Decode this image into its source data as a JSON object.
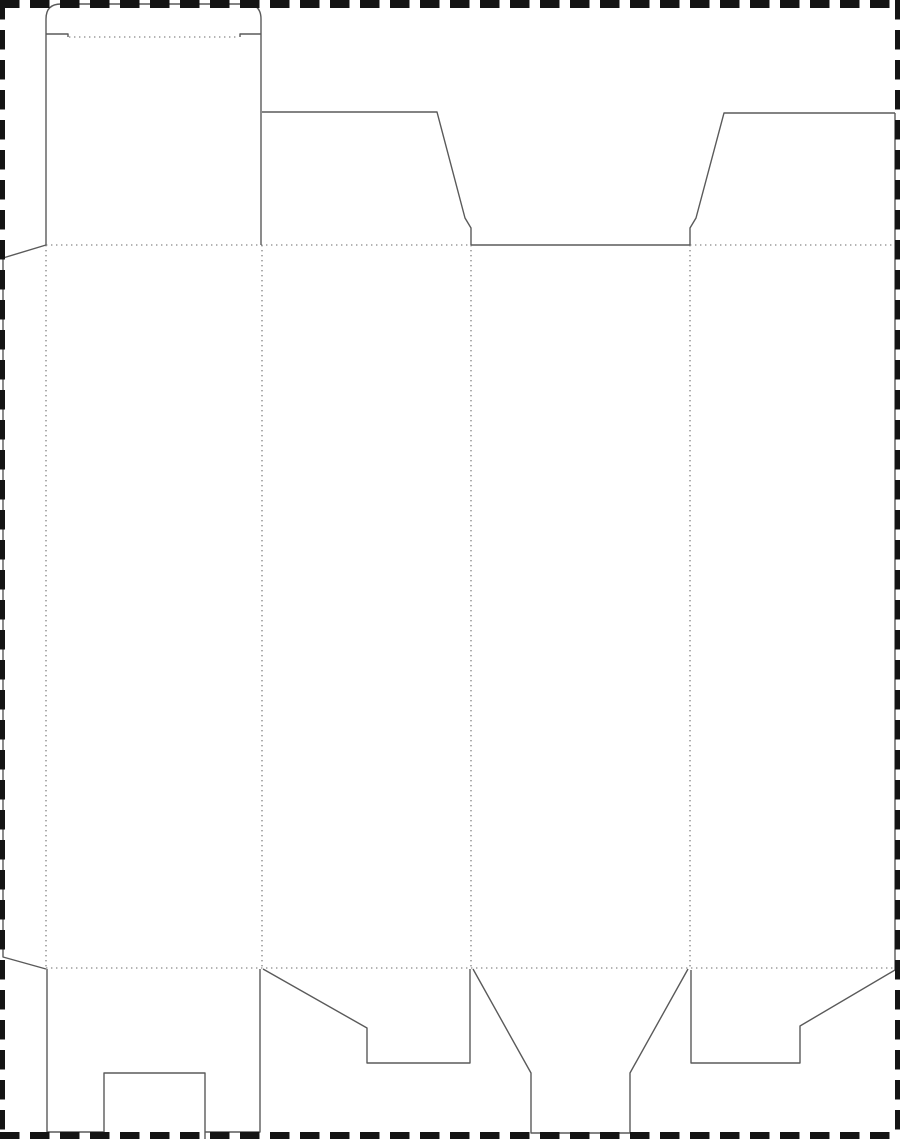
{
  "page": {
    "title": "box-dieline-template",
    "width": 900,
    "height": 1139,
    "background": "#ffffff"
  },
  "dieline": {
    "kind": "tuck-top-snap-lock-carton-dieline",
    "colors": {
      "cut_line": "#5a5a5a",
      "fold_line": "#6a6a6a",
      "border": "#141414",
      "background": "#ffffff"
    },
    "stroke": {
      "cut_width": 1.4,
      "fold_width": 1.1,
      "fold_dash": "1.4 3.6"
    },
    "border": {
      "dash": "19.5 10.5",
      "edges": [
        {
          "name": "border-top",
          "x1": 0,
          "y1": 4,
          "x2": 900,
          "y2": 4,
          "width": 8
        },
        {
          "name": "border-bottom",
          "x1": 0,
          "y1": 1135.5,
          "x2": 900,
          "y2": 1135.5,
          "width": 7
        },
        {
          "name": "border-left",
          "x1": 2.5,
          "y1": 0,
          "x2": 2.5,
          "y2": 1139,
          "width": 5
        },
        {
          "name": "border-right",
          "x1": 897.5,
          "y1": 0,
          "x2": 897.5,
          "y2": 1139,
          "width": 5
        }
      ]
    },
    "cut_paths": [
      {
        "name": "tuck-flap-outline",
        "d": "M 46 245 L 46 19 Q 46 4 61 4 L 246 4 Q 261 4 261 19 L 261 245"
      },
      {
        "name": "tuck-shoulder-left",
        "d": "M 46 34 L 68 34 L 68 37"
      },
      {
        "name": "tuck-shoulder-right",
        "d": "M 261 34 L 240 34 L 240 37"
      },
      {
        "name": "glue-flap-outline",
        "d": "M 46 245 L 3 258 L 3 957 L 46 969"
      },
      {
        "name": "dust-flap-left-outline",
        "d": "M 262 112 L 437 112 L 465 218 L 471 228 L 471 245"
      },
      {
        "name": "tuck-slot-cut",
        "d": "M 471 245 L 690 245"
      },
      {
        "name": "dust-flap-right-outline",
        "d": "M 690 245 L 690 228 L 696 218 L 724 113 L 895 113"
      },
      {
        "name": "right-edge-cut",
        "d": "M 895 113 L 895 970"
      },
      {
        "name": "bottom-flap-front",
        "d": "M 47 969 L 47 1132 L 104 1132 M 104 1139 L 104 1073 L 205 1073 L 205 1139 M 205 1132 L 260 1132 L 260 969"
      },
      {
        "name": "bottom-flap-side-left",
        "d": "M 263 969 L 367 1028 L 367 1063 L 470 1063 L 470 969"
      },
      {
        "name": "bottom-flap-funnel",
        "d": "M 473 969 L 531 1073 L 531 1133 L 630 1133 L 630 1073 L 688 969"
      },
      {
        "name": "bottom-flap-side-right",
        "d": "M 691 970 L 691 1063 L 800 1063 L 800 1026 L 895 970"
      }
    ],
    "fold_lines": [
      {
        "name": "tuck-fold",
        "x1": 69,
        "y1": 37,
        "x2": 239,
        "y2": 37
      },
      {
        "name": "top-fold-left-span",
        "x1": 46,
        "y1": 245,
        "x2": 471,
        "y2": 245
      },
      {
        "name": "top-fold-right-span",
        "x1": 690,
        "y1": 245,
        "x2": 895,
        "y2": 245
      },
      {
        "name": "bottom-fold",
        "x1": 46,
        "y1": 968,
        "x2": 895,
        "y2": 968
      },
      {
        "name": "panel-fold-glue",
        "x1": 46,
        "y1": 245,
        "x2": 46,
        "y2": 968
      },
      {
        "name": "panel-fold-1-2",
        "x1": 262,
        "y1": 245,
        "x2": 262,
        "y2": 968
      },
      {
        "name": "panel-fold-2-3",
        "x1": 471,
        "y1": 245,
        "x2": 471,
        "y2": 968
      },
      {
        "name": "panel-fold-3-4",
        "x1": 690,
        "y1": 245,
        "x2": 690,
        "y2": 968
      }
    ]
  }
}
